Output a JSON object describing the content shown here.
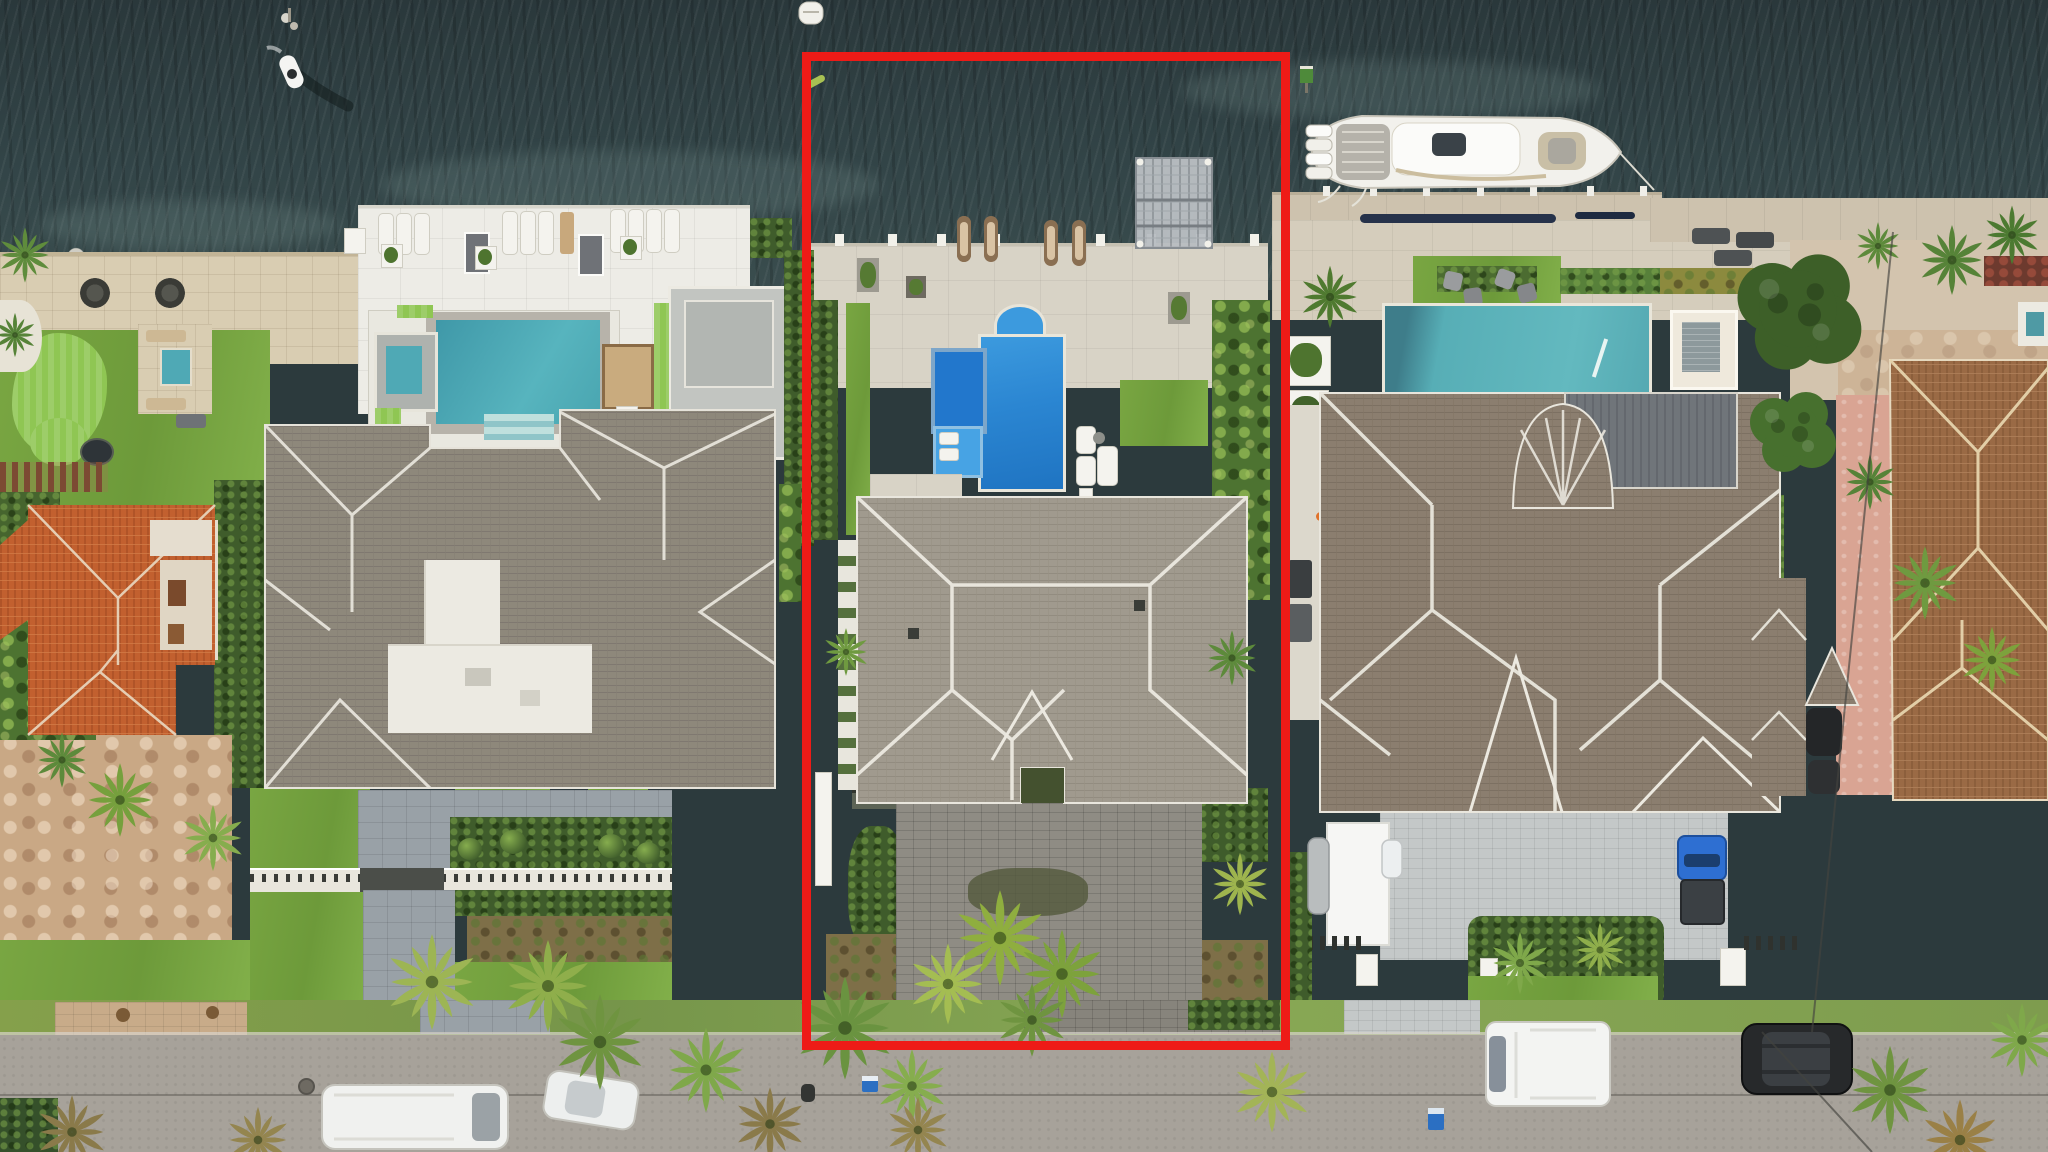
{
  "meta": {
    "type": "aerial-drone-photograph",
    "subject": "Top-down aerial view of waterfront luxury homes along an intracoastal waterway, one parcel outlined in red",
    "width_px": 2048,
    "height_px": 1152
  },
  "annotation": {
    "highlight_shape": "rectangle",
    "highlight_color": "#ee1b17",
    "purpose": "outlines the featured listing parcel"
  },
  "palette": {
    "red": "#ee1b17",
    "waterDeep": "#2a383b",
    "waterLight": "#3a4d4e",
    "poolLeft": "#4fa9b5",
    "poolCenter": "#2f8fd8",
    "spaCenter": "#2277cc",
    "shelfCenter": "#47a3e4",
    "poolRight": "#57aeb6",
    "roofLeft": "#8e887b",
    "roofCenter": "#a09a8e",
    "roofRight": "#8b7e6f",
    "roofMetal": "#70757a",
    "terraOrange": "#c2602f",
    "terraBrown": "#9a6a45",
    "ridgeWhite": "#efece4"
  },
  "water": {
    "label": "intracoastal-waterway",
    "features": [
      "jet-ski-with-wake",
      "white-dinghy",
      "green-kayak",
      "green-channel-marker",
      "mooring-piles"
    ]
  },
  "vessels": {
    "yacht": {
      "hull": "white",
      "outboard_engines": 4,
      "state": "docked at right property seawall"
    }
  },
  "properties": [
    {
      "id": "far-left-neighbor",
      "roof": "orange terracotta tile",
      "grounds": [
        "stone courtyard",
        "palms",
        "pergola"
      ]
    },
    {
      "id": "left-estate",
      "roof": "gray shingle with white flat section",
      "pool": "teal with spa and steps",
      "amenities": [
        "travertine patio",
        "putting-green",
        "fire-pit lounge",
        "chaise row",
        "boxwood parterre",
        "gated forecourt"
      ]
    },
    {
      "id": "center-estate-highlighted",
      "highlighted": true,
      "roof": "light gray shingle",
      "pool": "blue with raised spa and sun-shelf",
      "amenities": [
        "full-width waterfront deck",
        "boat-lift",
        "sun loungers",
        "paver driveway",
        "palm cluster"
      ]
    },
    {
      "id": "right-estate",
      "roof": "brown shingle with standing-seam metal section and curved turret",
      "pool": "teal with white spa box",
      "amenities": [
        "dock with yacht",
        "turf lounge",
        "white carport canopy",
        "paver motor-court"
      ],
      "vehicles": [
        "blue-pickup-truck",
        "silver-car",
        "white-car"
      ]
    },
    {
      "id": "far-right-neighbor",
      "roof": "brown barrel tile",
      "grounds": [
        "salmon courtyard",
        "palms",
        "two dark cars"
      ]
    }
  ],
  "street": {
    "label": "residential-street",
    "vehicles": [
      "white-van-south",
      "white-car-south",
      "white-box-van-north",
      "black-suv-north",
      "motorcycle"
    ],
    "bins": 2,
    "features": [
      "overhanging palms",
      "manhole",
      "utility-lines"
    ]
  }
}
